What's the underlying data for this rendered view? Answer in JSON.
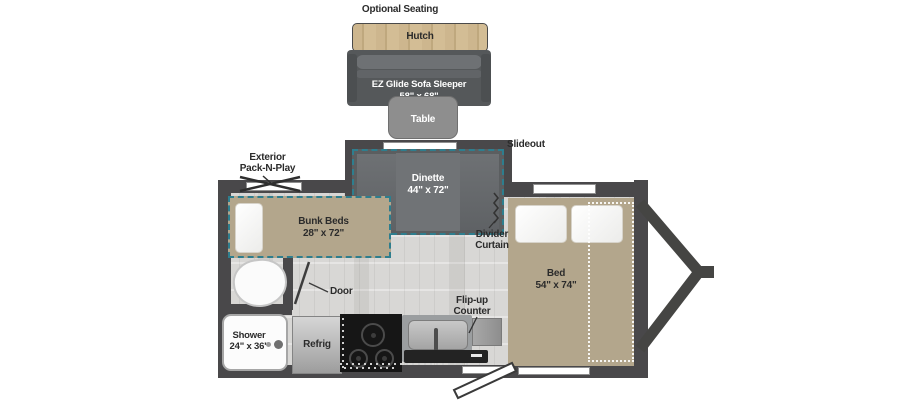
{
  "colors": {
    "wall": "#49484a",
    "teal": "#2e7e8e",
    "tan_bed": "#b3a68c",
    "wood": "#c9b289",
    "floor": "#d8d7d5",
    "dark_furniture": "#55585a"
  },
  "optional_seating": {
    "title": "Optional Seating",
    "hutch_label": "Hutch",
    "sofa_name": "EZ Glide Sofa Sleeper",
    "sofa_size": "58\" x 68\"",
    "table_label": "Table"
  },
  "slideout": {
    "label": "Slideout",
    "dinette_name": "Dinette",
    "dinette_size": "44\" x 72\""
  },
  "bunk_room": {
    "packnplay_line1": "Exterior",
    "packnplay_line2": "Pack-N-Play",
    "bunk_name": "Bunk Beds",
    "bunk_size": "28\" x 72\""
  },
  "bathroom": {
    "shower_name": "Shower",
    "shower_size": "24\" x 36\"",
    "door_label": "Door"
  },
  "kitchen": {
    "refrig_label": "Refrig",
    "flipup_line1": "Flip-up",
    "flipup_line2": "Counter"
  },
  "bedroom": {
    "divider_line1": "Divider",
    "divider_line2": "Curtain",
    "bed_name": "Bed",
    "bed_size": "54\" x 74\""
  }
}
